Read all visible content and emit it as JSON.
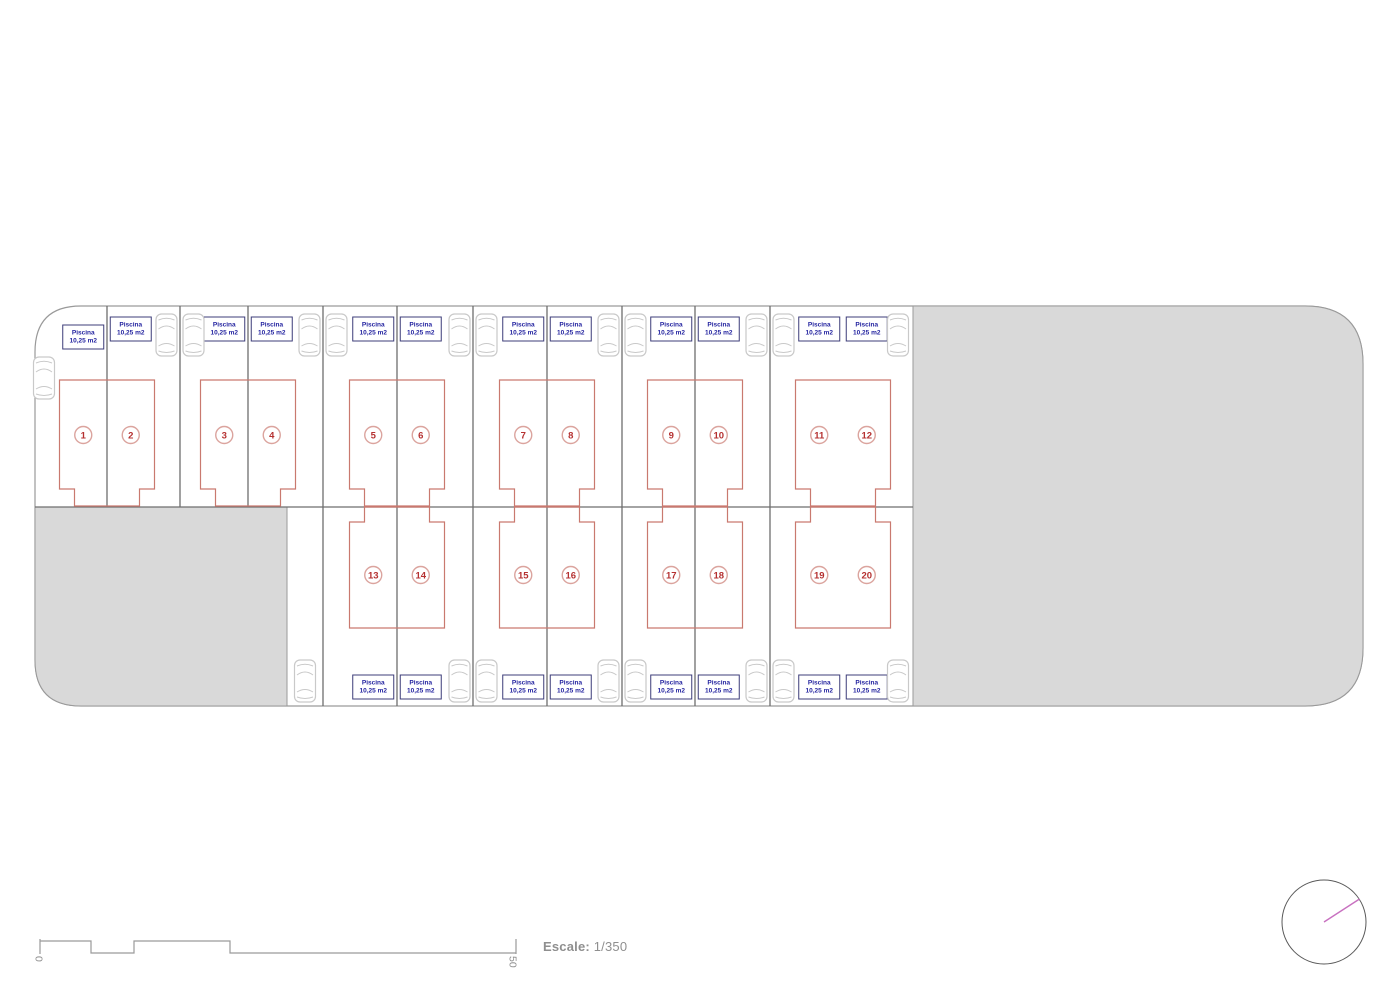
{
  "plots": [
    {
      "number": "1",
      "pool": {
        "line1": "Piscina",
        "line2": "10,25 m2"
      }
    },
    {
      "number": "2",
      "pool": {
        "line1": "Piscina",
        "line2": "10,25 m2"
      }
    },
    {
      "number": "3",
      "pool": {
        "line1": "Piscina",
        "line2": "10,25 m2"
      }
    },
    {
      "number": "4",
      "pool": {
        "line1": "Piscina",
        "line2": "10,25 m2"
      }
    },
    {
      "number": "5",
      "pool": {
        "line1": "Piscina",
        "line2": "10,25 m2"
      }
    },
    {
      "number": "6",
      "pool": {
        "line1": "Piscina",
        "line2": "10,25 m2"
      }
    },
    {
      "number": "7",
      "pool": {
        "line1": "Piscina",
        "line2": "10,25 m2"
      }
    },
    {
      "number": "8",
      "pool": {
        "line1": "Piscina",
        "line2": "10,25 m2"
      }
    },
    {
      "number": "9",
      "pool": {
        "line1": "Piscina",
        "line2": "10,25 m2"
      }
    },
    {
      "number": "10",
      "pool": {
        "line1": "Piscina",
        "line2": "10,25 m2"
      }
    },
    {
      "number": "11",
      "pool": {
        "line1": "Piscina",
        "line2": "10,25 m2"
      }
    },
    {
      "number": "12",
      "pool": {
        "line1": "Piscina",
        "line2": "10,25 m2"
      }
    },
    {
      "number": "13",
      "pool": {
        "line1": "Piscina",
        "line2": "10,25 m2"
      }
    },
    {
      "number": "14",
      "pool": {
        "line1": "Piscina",
        "line2": "10,25 m2"
      }
    },
    {
      "number": "15",
      "pool": {
        "line1": "Piscina",
        "line2": "10,25 m2"
      }
    },
    {
      "number": "16",
      "pool": {
        "line1": "Piscina",
        "line2": "10,25 m2"
      }
    },
    {
      "number": "17",
      "pool": {
        "line1": "Piscina",
        "line2": "10,25 m2"
      }
    },
    {
      "number": "18",
      "pool": {
        "line1": "Piscina",
        "line2": "10,25 m2"
      }
    },
    {
      "number": "19",
      "pool": {
        "line1": "Piscina",
        "line2": "10,25 m2"
      }
    },
    {
      "number": "20",
      "pool": {
        "line1": "Piscina",
        "line2": "10,25 m2"
      }
    }
  ],
  "scale": {
    "label": "Escale:",
    "value": "1/350",
    "bar_start_tick": "0",
    "bar_end_tick": "50"
  },
  "icons": {
    "compass": "north-compass-icon",
    "car": "car-icon"
  },
  "colors": {
    "house_outline": "#c9796f",
    "plot_number": "#b53030",
    "number_circle": "#dba49e",
    "pool_text": "#1f1f9e",
    "pool_box_border": "#3c3c78",
    "parcel_line": "#6e6e6e",
    "boundary": "#9a9a9a",
    "paved_fill": "#d9d9d9",
    "car_outline": "#c9c9c9",
    "scale_line": "#9a9a9a",
    "compass_needle": "#c871c0",
    "compass_ring": "#5a5a5a"
  }
}
